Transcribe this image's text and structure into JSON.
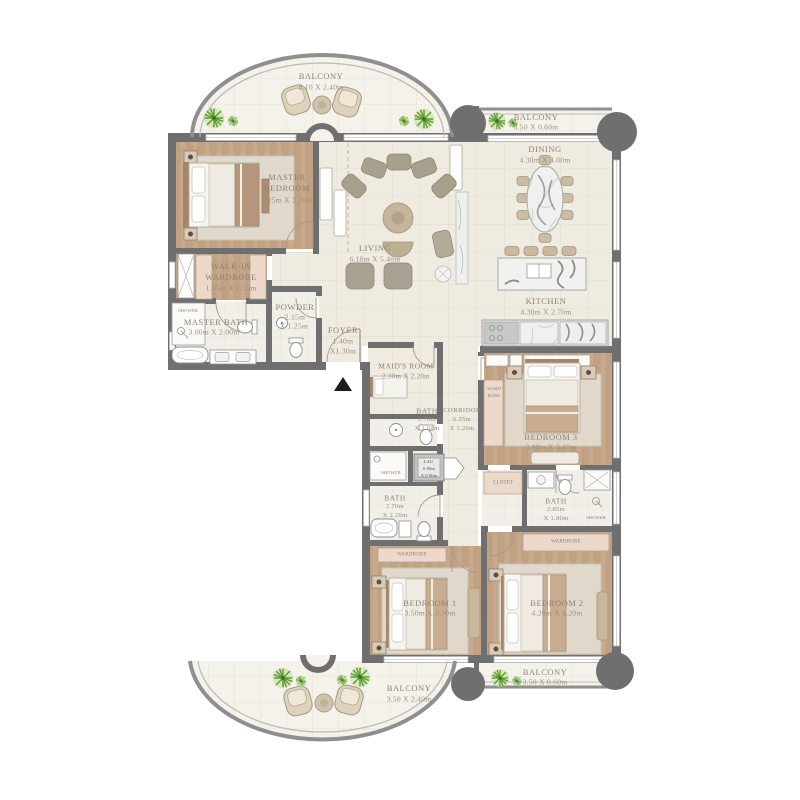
{
  "rooms": {
    "balconyTop": {
      "name": "BALCONY",
      "dim": "8.10 X 2.40m"
    },
    "balconyTopRight": {
      "name": "BALCONY",
      "dim": "3.50 X 0.60m"
    },
    "dining": {
      "name": "DINING",
      "dim": "4.30m X 4.00m"
    },
    "living": {
      "name": "LIVING",
      "dim": "6.10m X 5.40m"
    },
    "kitchen": {
      "name": "KITCHEN",
      "dim": "4.30m X 2.70m"
    },
    "masterBedroom": {
      "name1": "MASTER",
      "name2": "BEDROOM",
      "dim": "4.25m X 3.70m"
    },
    "walkIn": {
      "name1": "WALK-IN",
      "name2": "WARDROBE",
      "dim": "1.65m X 1.55m"
    },
    "masterBath": {
      "name": "MASTER BATH",
      "dim": "3.00m X 2.00m"
    },
    "powder": {
      "name": "POWDER",
      "dim1": "2.15m",
      "dim2": "X 1.25m"
    },
    "foyer": {
      "name": "FOYER",
      "dim1": "1.40m",
      "dim2": "X1.30m"
    },
    "maidsRoom": {
      "name": "MAID'S ROOM",
      "dim": "2.30m X 2.20m"
    },
    "bathMaid": {
      "name": "BATH",
      "dim1": "1.70m",
      "dim2": "X 1.60m"
    },
    "corridor": {
      "name": "CORRIDOR",
      "dim1": "6.55m",
      "dim2": "X 1.20m"
    },
    "laundry": {
      "name": "LAU.",
      "dim1": "0.90m",
      "dim2": "X 0.90m"
    },
    "bath1": {
      "name": "BATH",
      "dim1": "2.70m",
      "dim2": "X 2.20m"
    },
    "bath3": {
      "name": "BATH",
      "dim1": "2.85m",
      "dim2": "X 1.80m"
    },
    "bedroom1": {
      "name": "BEDROOM 1",
      "dim": "3.50m X 3.30m"
    },
    "bedroom2": {
      "name": "BEDROOM 2",
      "dim": "4.20m X 4.20m"
    },
    "bedroom3": {
      "name": "BEDROOM 3",
      "dim": "3.80m X 3.40m"
    },
    "balconyBottom": {
      "name": "BALCONY",
      "dim": "3.50 X 2.40m"
    },
    "balconyBottomRight": {
      "name": "BALCONY",
      "dim": "3.50 X 0.60m"
    }
  },
  "small": {
    "showerMaster": "SHOWER",
    "showerMid": "SHOWER",
    "showerBath3": "SHOWER",
    "closet": "CLOSET",
    "wardrobe1": "WARDROBE",
    "wardrobe2": "WARDROBE",
    "ward3a": "WARD",
    "ward3b": "ROBE"
  },
  "palette": {
    "wall": "#6f6f6f",
    "wood": "#c7a98c",
    "tile": "#efebe1",
    "closet_fill": "#ecd9c9",
    "plant_green": "#5f9b33"
  }
}
